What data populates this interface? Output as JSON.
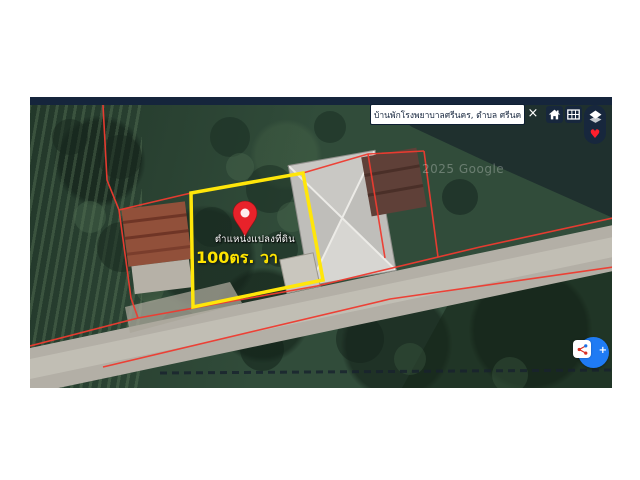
{
  "search": {
    "value": "บ้านพักโรงพยาบาลศรีนคร, ตำบล ศรีนคร อำเภ",
    "close_label": "×"
  },
  "toolbar": {
    "heart_glyph": "♥"
  },
  "map": {
    "watermark": "2025 Google",
    "parcel": {
      "position_label": "ตำแหน่งแปลงที่ดิน",
      "area_label": "100ตร. วา"
    }
  },
  "share": {
    "plus_glyph": "+"
  },
  "colors": {
    "parcel_yellow": "#ffe60a",
    "boundary_red": "#ef3b30",
    "pin_red": "#e8222a",
    "ui_navy": "#17273d",
    "share_blue": "#1f7bf4"
  }
}
